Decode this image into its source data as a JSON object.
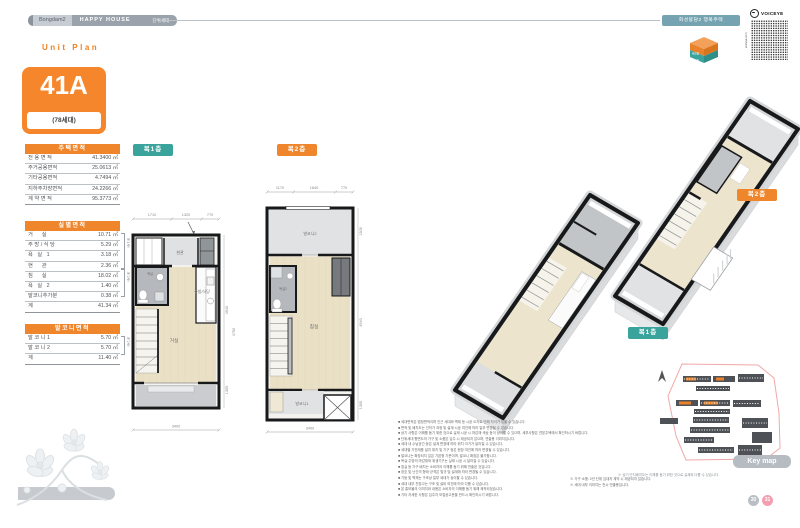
{
  "colors": {
    "accent_orange": "#f0862c",
    "accent_teal": "#3aa39b",
    "header_gray": "#9aa3ab",
    "wall_black": "#17191b",
    "floor_beige": "#e9e0c6",
    "keymap_outline": "#f0a8a8"
  },
  "header": {
    "brand_prefix": "Bongdam2",
    "brand_main": "HAPPY HOUSE",
    "brand_suffix": "단위세대",
    "project_badge": "화성봉담2 행복주택",
    "voiceye_label": "VOICEYE",
    "voiceye_side": "voiceye.com",
    "cube_top_label": "복2층",
    "cube_bottom_label": "복1층"
  },
  "section_label": "Unit Plan",
  "unit": {
    "code": "41A",
    "households": "(78세대)"
  },
  "area_tables": {
    "housing": {
      "title": "주택면적",
      "rows": [
        {
          "label": "전 용 면 적",
          "value": "41.3400 ㎡"
        },
        {
          "label": "주거공용면적",
          "value": "25.0613 ㎡"
        },
        {
          "label": "기타공용면적",
          "value": "4.7494 ㎡"
        },
        {
          "label": "지하주차장면적",
          "value": "24.2266 ㎡"
        },
        {
          "label": "계 약 면 적",
          "value": "95.3773 ㎡"
        }
      ]
    },
    "rooms": {
      "title": "실별면적",
      "rows": [
        {
          "label": "거      실",
          "value": "10.71 ㎡"
        },
        {
          "label": "주 방 / 식 당",
          "value": "5.29 ㎡"
        },
        {
          "label": "욕   실   1",
          "value": "3.18 ㎡"
        },
        {
          "label": "현      관",
          "value": "2.36 ㎡"
        },
        {
          "label": "침      실",
          "value": "18.02 ㎡"
        },
        {
          "label": "욕   실   2",
          "value": "1.40 ㎡"
        },
        {
          "label": "발코니추가분",
          "value": "0.38 ㎡"
        },
        {
          "label": "계",
          "value": "41.34 ㎡"
        }
      ],
      "bracket_floor1": "복1층",
      "bracket_floor2": "복2층"
    },
    "balcony": {
      "title": "발코니면적",
      "rows": [
        {
          "label": "발 코 니 1",
          "value": "5.70 ㎡"
        },
        {
          "label": "발 코 니 2",
          "value": "5.70 ㎡"
        },
        {
          "label": "계",
          "value": "11.40 ㎡"
        }
      ],
      "bracket": "복2층"
    }
  },
  "plans": {
    "floor1": {
      "label": "복1층",
      "dims_top": [
        "1710",
        "1320",
        "770"
      ],
      "dims_right": [
        "4940",
        "4750",
        "1305"
      ],
      "dim_bottom": "3400",
      "room_entrance": "현관",
      "room_bath": "욕실",
      "room_kitchen": "주방/식당",
      "room_living": "거실"
    },
    "floor2": {
      "label": "복2층",
      "dims_top": [
        "1170",
        "1840",
        "770"
      ],
      "dims_right": [
        "1305",
        "4940",
        "1305"
      ],
      "dim_bottom": "3400",
      "room_balcony2": "발코니2",
      "room_bath2": "욕실2",
      "room_bedroom": "침실",
      "room_balcony1": "발코니1"
    }
  },
  "renders": {
    "floor1_label": "복1층",
    "floor2_label": "복2층"
  },
  "keymap": {
    "label": "Key map",
    "caption": "※ 상기 단지배치도는 이해를 돕기 위한 것으로 실제와 다를 수 있습니다."
  },
  "notes": {
    "left": [
      "■ 세대면적은 법정면적이며 인근 세대와 벽체 등 시공 오차로 인해 차이가 있을 수 있습니다.",
      "■ 면적 및 배치도는 인허가 과정 및 설계·시공 여건에 따라 일부 변경될 수 있습니다.",
      "■ 상기 사항은 이해를 돕기 위한 것으로 실제 시공 시 마감재·색상 등이 상이할 수 있으며, 세부사항은 견본주택에서 확인하시기 바랍니다.",
      "■ 단위세대 평면도의 가구 및 소품은 입주 시 제공되지 않으며, 연출용 이미지입니다.",
      "■ 세대 내 수납공간 등은 설계 변경에 따라 위치·크기가 달라질 수 있습니다.",
      "■ 세대별 가전제품 설치 위치 및 기구 등은 현장 여건에 따라 변경될 수 있습니다.",
      "■ 발코니는 확장되지 않은 기본형 기준이며, 발코니 확장은 불가합니다.",
      "■ 욕실·주방의 마감재와 위생기구는 실제 시공 시 달라질 수 있습니다.",
      "■ 침실 등 가구 배치는 소비자의 이해를 돕기 위해 연출된 것입니다.",
      "■ 창호 및 난간의 형태·규격은 법규 및 설계에 따라 변경될 수 있습니다.",
      "■ 기둥 및 벽체는 구조상 일부 세대가 상이할 수 있습니다.",
      "■ 세대 내부 천장고는 구조 및 설비 여건에 따라 다를 수 있습니다.",
      "■ 본 홍보물의 이미지와 내용은 소비자의 이해를 돕기 위해 제작되었습니다.",
      "■ 기타 자세한 사항은 입주자 모집공고문을 반드시 확인하시기 바랍니다."
    ],
    "right": [
      "※ 가구·소품: 2년 단위 임대차 계약 시 제공되지 않습니다.",
      "※ 세대 내부 이미지는 전시·연출용입니다."
    ]
  },
  "pager": {
    "prev": "30",
    "next": "31"
  }
}
